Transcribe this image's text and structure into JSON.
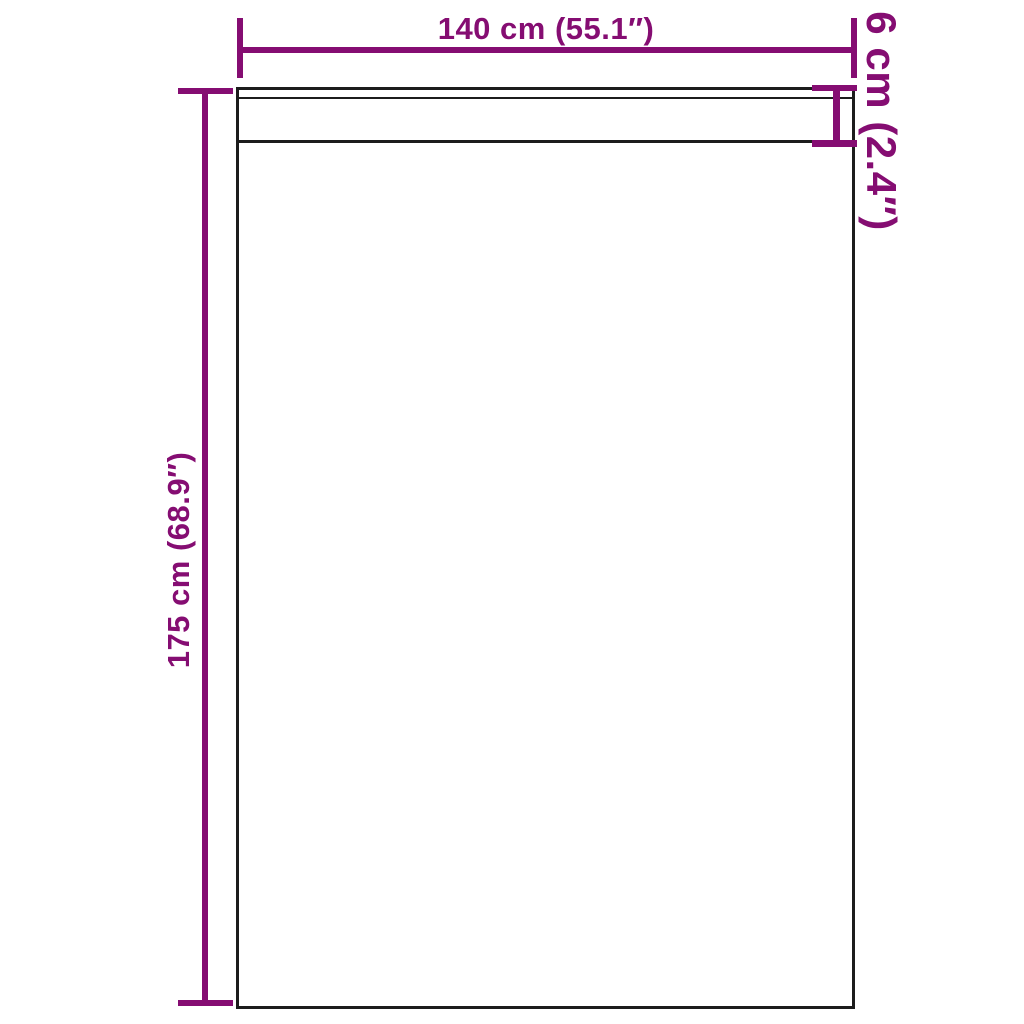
{
  "diagram": {
    "kind": "product-dimension-diagram",
    "subject": "rectangular panel with top hem strip",
    "colors": {
      "dimension_accent": "#850d72",
      "outline": "#1c1c1c",
      "background": "#ffffff"
    },
    "dimensions": {
      "width": {
        "label": "140 cm (55.1″)",
        "orientation": "horizontal-top"
      },
      "height": {
        "label": "175 cm (68.9″)",
        "orientation": "vertical-left"
      },
      "hem": {
        "label": "6 cm (2.4″)",
        "orientation": "vertical-right"
      }
    }
  }
}
